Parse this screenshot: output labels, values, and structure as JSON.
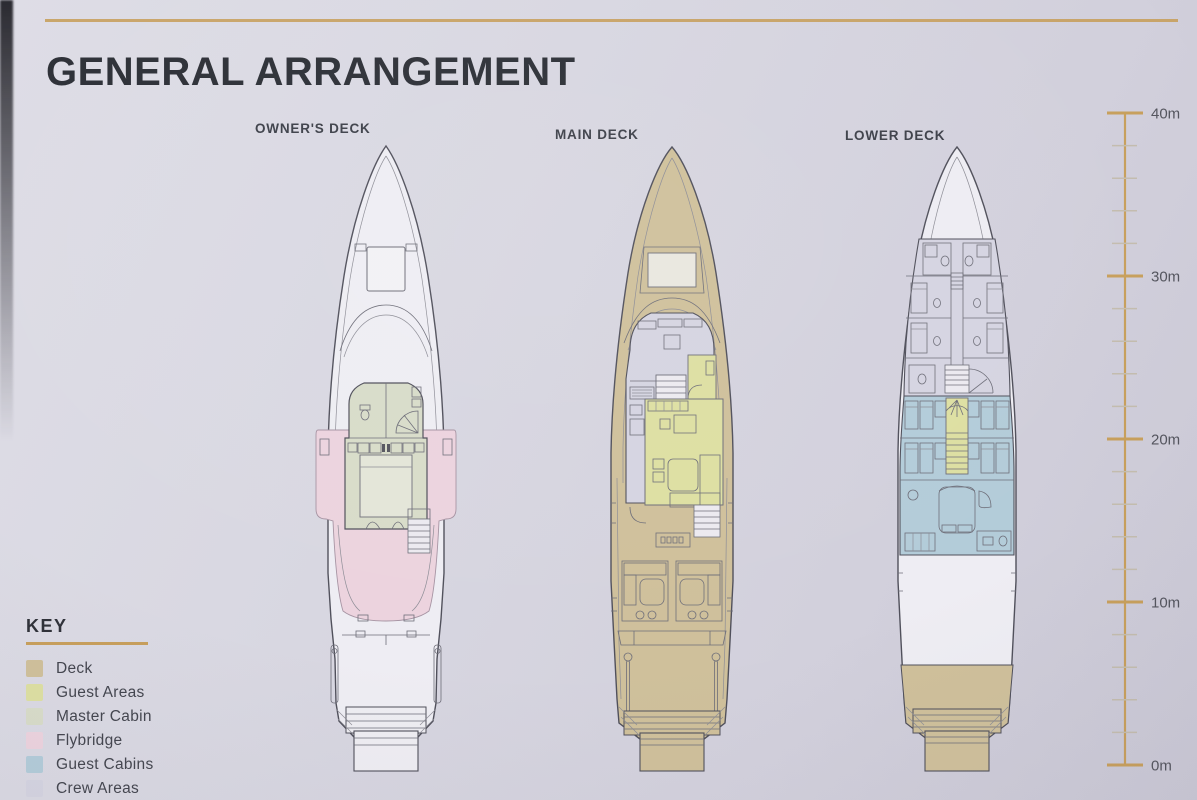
{
  "page": {
    "title": "GENERAL ARRANGEMENT"
  },
  "decks": [
    {
      "label": "OWNER'S DECK"
    },
    {
      "label": "MAIN DECK"
    },
    {
      "label": "LOWER DECK"
    }
  ],
  "scale_bar": {
    "unit_suffix": "m",
    "max_m": 40,
    "min_m": 0,
    "major_step_m": 10,
    "minor_step_m": 2,
    "major_labels": [
      "40m",
      "30m",
      "20m",
      "10m",
      "0m"
    ],
    "line_color": "#c79f5c",
    "minor_tick_color": "#c3bcae",
    "label_color": "#54555e"
  },
  "key": {
    "title": "KEY",
    "items": [
      {
        "label": "Deck",
        "color": "#cfc09b"
      },
      {
        "label": "Guest Areas",
        "color": "#dddfa2"
      },
      {
        "label": "Master Cabin",
        "color": "#d8dcc9"
      },
      {
        "label": "Flybridge",
        "color": "#ecd3de"
      },
      {
        "label": "Guest Cabins",
        "color": "#b3ccd9"
      },
      {
        "label": "Crew Areas",
        "color": "#d5d4e1"
      }
    ]
  },
  "colors": {
    "accent_gold": "#c79f5c",
    "title_text": "#2d3037",
    "outline": "#50505b",
    "hull_white": "#eeedf3"
  }
}
